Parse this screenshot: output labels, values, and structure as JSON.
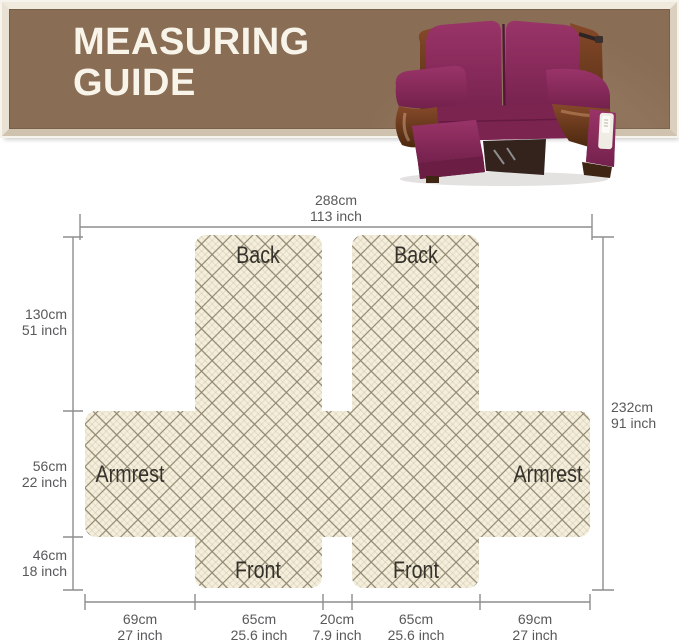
{
  "header": {
    "title_line1": "MEASURING",
    "title_line2": "GUIDE"
  },
  "hero_image": {
    "subject": "burgundy quilted loveseat recliner cover on brown leather recliner"
  },
  "diagram": {
    "panels": [
      {
        "id": "back-left",
        "label": "Back"
      },
      {
        "id": "back-right",
        "label": "Back"
      },
      {
        "id": "armrest-left",
        "label": "Armrest"
      },
      {
        "id": "armrest-right",
        "label": "Armrest"
      },
      {
        "id": "front-left",
        "label": "Front"
      },
      {
        "id": "front-right",
        "label": "Front"
      }
    ],
    "measurements": {
      "top": {
        "cm": "288cm",
        "inch": "113 inch"
      },
      "right": {
        "cm": "232cm",
        "inch": "91 inch"
      },
      "left": [
        {
          "cm": "130cm",
          "inch": "51 inch"
        },
        {
          "cm": "56cm",
          "inch": "22 inch"
        },
        {
          "cm": "46cm",
          "inch": "18 inch"
        }
      ],
      "bottom": [
        {
          "cm": "69cm",
          "inch": "27 inch"
        },
        {
          "cm": "65cm",
          "inch": "25.6 inch"
        },
        {
          "cm": "20cm",
          "inch": "7.9 inch"
        },
        {
          "cm": "65cm",
          "inch": "25.6 inch"
        },
        {
          "cm": "69cm",
          "inch": "27 inch"
        }
      ]
    }
  },
  "colors": {
    "banner_brown": "#8c6f56",
    "frame_beige": "#e9e1d3",
    "title_text": "#f8f4e9",
    "fabric_cream": "#f4eedb",
    "lattice_line": "#8f8670",
    "dimension_line": "#8d8d8d",
    "measure_text": "#58585a",
    "panel_text": "#35322b",
    "cover_burgundy": "#8c2b5c",
    "leather_brown": "#6b3a1e"
  }
}
